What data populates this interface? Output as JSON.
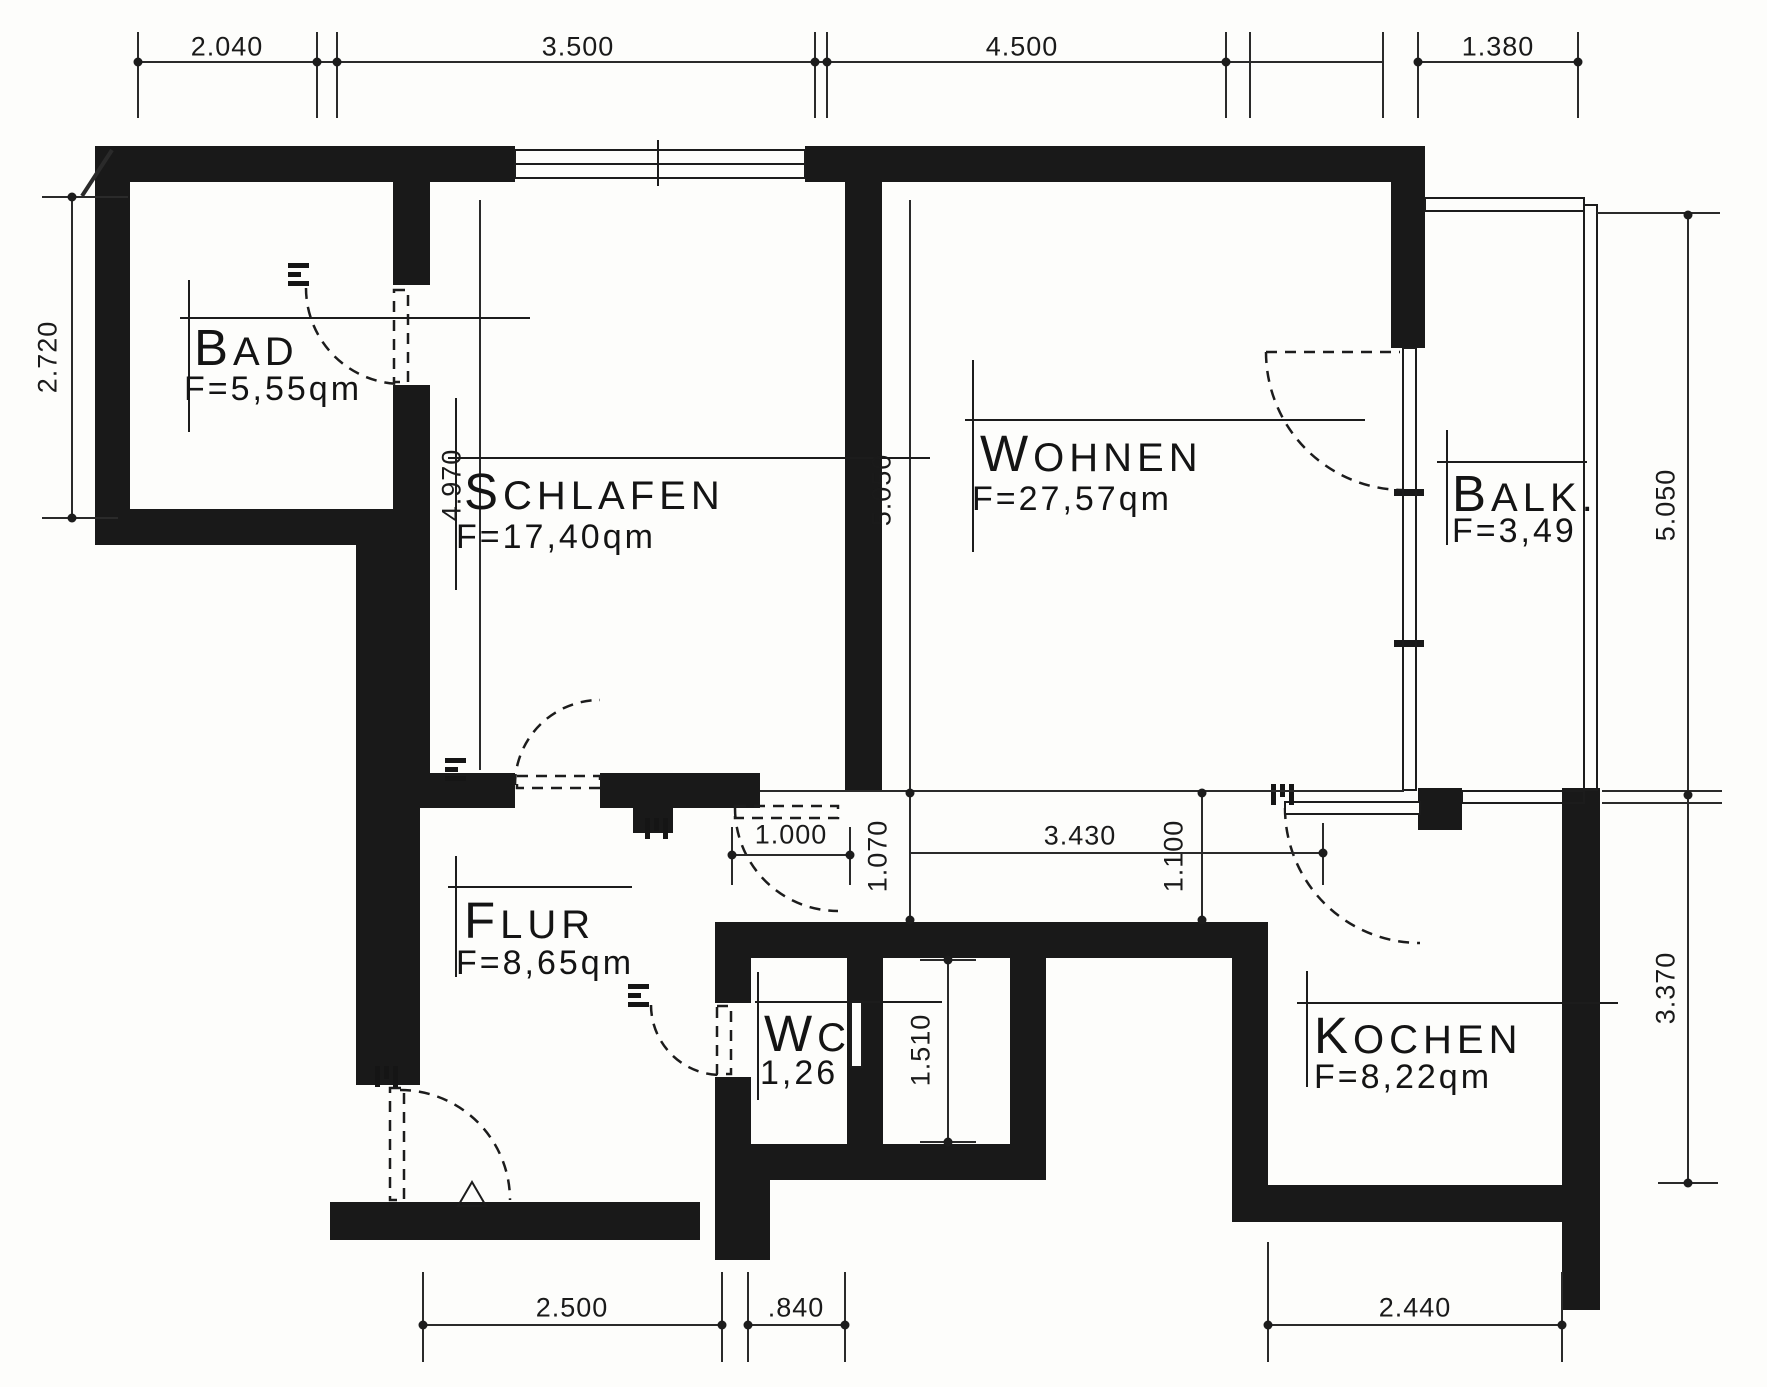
{
  "drawing": {
    "type": "apartment-floor-plan",
    "ink_color": "#191919",
    "paper_color": "#fdfdfb"
  },
  "rooms": {
    "bad": {
      "name": "BAD",
      "area": "F=5,55qm"
    },
    "schlafen": {
      "name": "SCHLAFEN",
      "area": "F=17,40qm"
    },
    "wohnen": {
      "name": "WOHNEN",
      "area": "F=27,57qm"
    },
    "balkon": {
      "name": "BALK.",
      "area": "F=3,49"
    },
    "flur": {
      "name": "FLUR",
      "area": "F=8,65qm"
    },
    "wc": {
      "name": "WC",
      "area": "1,26"
    },
    "kochen": {
      "name": "KOCHEN",
      "area": "F=8,22qm"
    }
  },
  "dimensions": {
    "top": [
      "2.040",
      "3.500",
      "4.500",
      "1.380"
    ],
    "bottom": [
      "2.500",
      ".840",
      "2.440"
    ],
    "left": [
      "2.720"
    ],
    "right": [
      "5.050",
      "3.370"
    ],
    "interior": {
      "schlafen_height": "4.970",
      "wohnen_height": "5.050",
      "corridor_left": "1.070",
      "corridor_width": "3.430",
      "corridor_right": "1.100",
      "flur_door": "1.000",
      "shaft": "1.510"
    }
  }
}
